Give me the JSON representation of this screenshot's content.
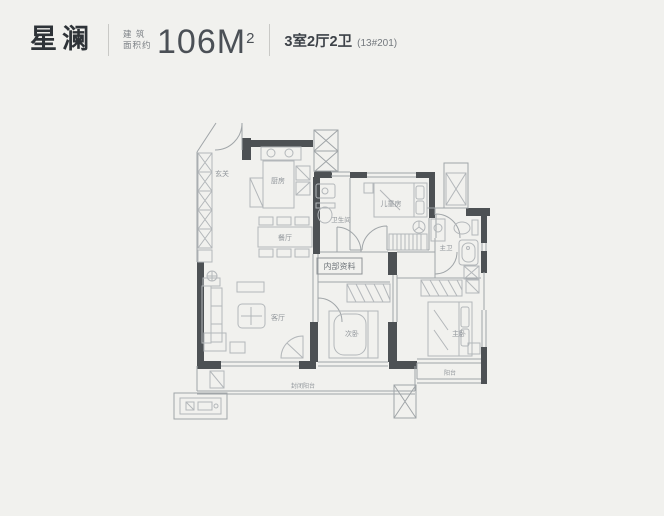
{
  "page": {
    "background": "#f1f1ee"
  },
  "header": {
    "project_name": "星澜",
    "area_prefix_line1": "建 筑",
    "area_prefix_line2": "面积约",
    "area_value": "106M",
    "area_sup": "2",
    "layout_text": "3室2厅2卫",
    "unit_number": "(13#201)"
  },
  "watermark": {
    "text": "内部资料"
  },
  "plan": {
    "colors": {
      "wall": "#4d5154",
      "line": "#a0a5a8",
      "furniture": "#b3b7ba",
      "label": "#90959a"
    },
    "labels": {
      "entry": "玄关",
      "kitchen": "厨房",
      "dining": "餐厅",
      "bath": "卫生间",
      "kids_room": "儿童房",
      "master_bath": "主卫",
      "living": "客厅",
      "second_bed": "次卧",
      "master_bed": "主卧",
      "balcony": "阳台",
      "enclosed_balcony": "封闭阳台"
    }
  }
}
